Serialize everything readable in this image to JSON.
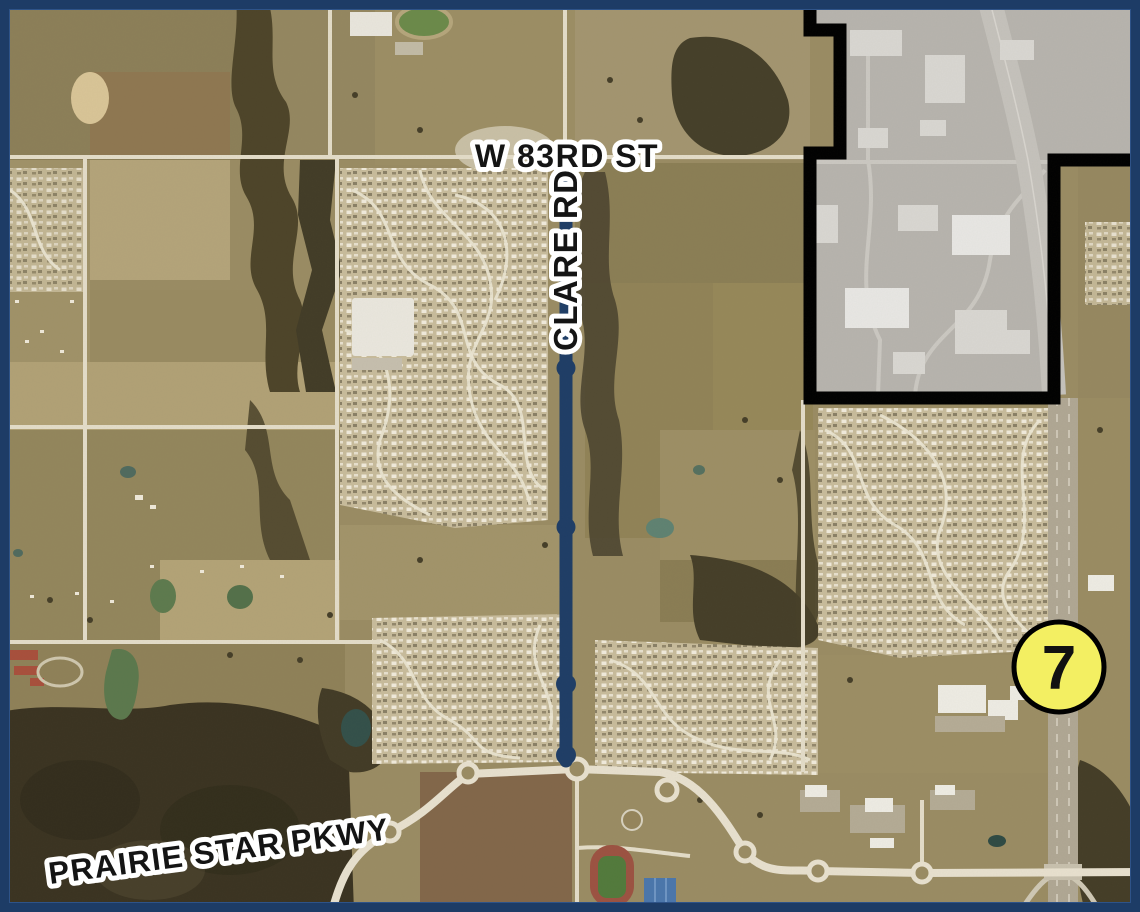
{
  "map": {
    "description": "Aerial map with Clare Rd corridor highlighted, excluded industrial area outlined in black, and K-7 highway marker",
    "labels": {
      "street_top": "W 83RD ST",
      "street_vertical": "CLARE RD",
      "street_bottom": "PRAIRIE STAR PKWY"
    },
    "highway_marker": {
      "number": "7"
    },
    "colors": {
      "frame": "#1d3c66",
      "route_highlight": "#1e3d66",
      "excluded_area_fill": "#b7b4ae",
      "excluded_area_outline": "#000000",
      "marker_fill": "#f3ef62",
      "marker_outline": "#000000",
      "label_text": "#141414",
      "label_halo": "#ffffff"
    }
  }
}
